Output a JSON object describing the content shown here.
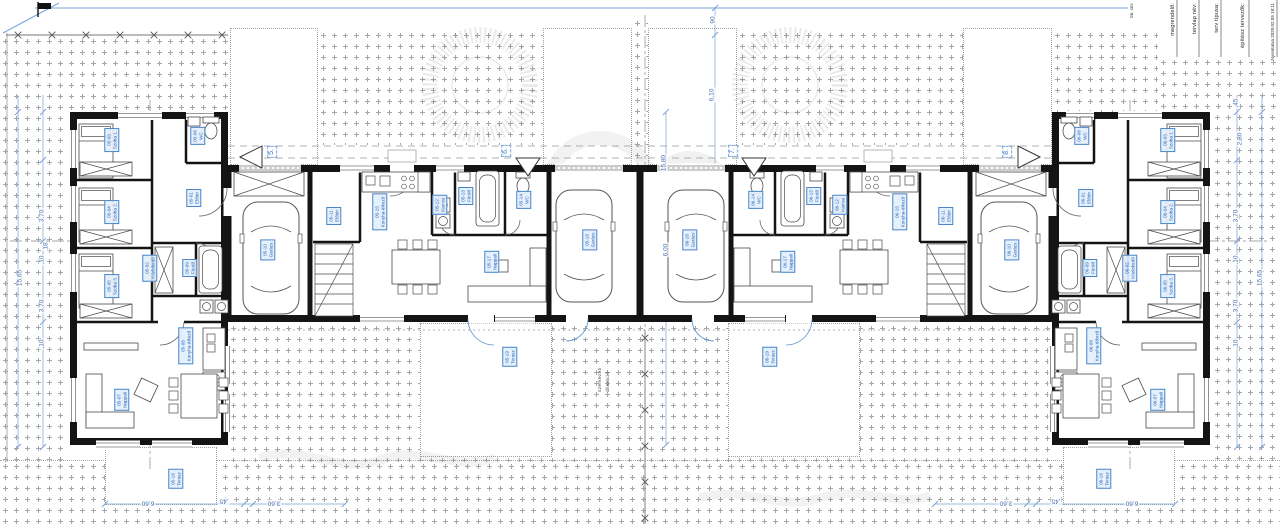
{
  "drawing": {
    "title_block": {
      "fields": [
        "megrendelő:",
        "tervlap név:",
        "terv típusa:",
        "építész tervezők:"
      ],
      "print_note": "Nyomtatva 2020.02.09 18:11",
      "side_note": "tm. cm:"
    },
    "section_markers": [
      {
        "label": "5.",
        "x": 272,
        "y": 152
      },
      {
        "label": "6.",
        "x": 506,
        "y": 151
      },
      {
        "label": "7.",
        "x": 733,
        "y": 151
      },
      {
        "label": "8.",
        "x": 1007,
        "y": 152
      }
    ],
    "room_labels": [
      {
        "code": "05-01",
        "name": "Előtér",
        "x": 194,
        "y": 198
      },
      {
        "code": "05-02",
        "name": "Közlekedő",
        "x": 150,
        "y": 268
      },
      {
        "code": "05-03",
        "name": "Szoba 1.",
        "x": 112,
        "y": 140
      },
      {
        "code": "05-04",
        "name": "Szoba 2.",
        "x": 112,
        "y": 212
      },
      {
        "code": "05-05",
        "name": "Szoba 3.",
        "x": 112,
        "y": 286
      },
      {
        "code": "05-06",
        "name": "WC",
        "x": 198,
        "y": 136
      },
      {
        "code": "05-07",
        "name": "Nappali",
        "x": 122,
        "y": 400
      },
      {
        "code": "05-08",
        "name": "Konyha-étkező",
        "x": 186,
        "y": 346
      },
      {
        "code": "05-09",
        "name": "Fürdő",
        "x": 190,
        "y": 268
      },
      {
        "code": "05-10",
        "name": "Garázs",
        "x": 268,
        "y": 250
      },
      {
        "code": "05-16",
        "name": "Terasz",
        "x": 176,
        "y": 479
      },
      {
        "code": "05-11",
        "name": "Előtér",
        "x": 334,
        "y": 216
      },
      {
        "code": "05-12",
        "name": "Kamra",
        "x": 440,
        "y": 205
      },
      {
        "code": "05-13",
        "name": "Fürdő",
        "x": 466,
        "y": 196
      },
      {
        "code": "05-14",
        "name": "WC",
        "x": 524,
        "y": 200
      },
      {
        "code": "05-15",
        "name": "Konyha-étkező",
        "x": 380,
        "y": 212
      },
      {
        "code": "05-17",
        "name": "Nappali",
        "x": 492,
        "y": 262
      },
      {
        "code": "05-18",
        "name": "Garázs",
        "x": 590,
        "y": 240
      },
      {
        "code": "05-19",
        "name": "Terasz",
        "x": 510,
        "y": 357
      },
      {
        "code": "06-11",
        "name": "Előtér",
        "x": 946,
        "y": 216
      },
      {
        "code": "06-12",
        "name": "Kamra",
        "x": 840,
        "y": 205
      },
      {
        "code": "06-13",
        "name": "Fürdő",
        "x": 814,
        "y": 196
      },
      {
        "code": "06-14",
        "name": "WC",
        "x": 756,
        "y": 200
      },
      {
        "code": "06-15",
        "name": "Konyha-étkező",
        "x": 900,
        "y": 212
      },
      {
        "code": "06-17",
        "name": "Nappali",
        "x": 788,
        "y": 262
      },
      {
        "code": "06-18",
        "name": "Garázs",
        "x": 690,
        "y": 240
      },
      {
        "code": "06-19",
        "name": "Terasz",
        "x": 770,
        "y": 357
      },
      {
        "code": "06-01",
        "name": "Előtér",
        "x": 1086,
        "y": 198
      },
      {
        "code": "06-02",
        "name": "Közlekedő",
        "x": 1130,
        "y": 268
      },
      {
        "code": "06-03",
        "name": "Szoba 1.",
        "x": 1168,
        "y": 140
      },
      {
        "code": "06-04",
        "name": "Szoba 2.",
        "x": 1168,
        "y": 212
      },
      {
        "code": "06-05",
        "name": "Szoba 3.",
        "x": 1168,
        "y": 286
      },
      {
        "code": "06-06",
        "name": "WC",
        "x": 1082,
        "y": 136
      },
      {
        "code": "06-07",
        "name": "Nappali",
        "x": 1158,
        "y": 400
      },
      {
        "code": "06-08",
        "name": "Konyha-étkező",
        "x": 1094,
        "y": 346
      },
      {
        "code": "06-09",
        "name": "Fürdő",
        "x": 1090,
        "y": 268
      },
      {
        "code": "06-10",
        "name": "Garázs",
        "x": 1012,
        "y": 250
      },
      {
        "code": "06-16",
        "name": "Terasz",
        "x": 1104,
        "y": 479
      }
    ],
    "dimensions": [
      {
        "text": "90",
        "x": 713,
        "y": 20
      },
      {
        "text": "6,10",
        "x": 712,
        "y": 95
      },
      {
        "text": "15,80",
        "x": 664,
        "y": 163
      },
      {
        "text": "6,00",
        "x": 666,
        "y": 250
      },
      {
        "text": "18",
        "x": 46,
        "y": 246
      },
      {
        "text": ",45",
        "x": 1236,
        "y": 103
      },
      {
        "text": "2,80",
        "x": 1240,
        "y": 139
      },
      {
        "text": "3,70",
        "x": 1236,
        "y": 216
      },
      {
        "text": ",10",
        "x": 1236,
        "y": 260
      },
      {
        "text": "3,70",
        "x": 1236,
        "y": 306
      },
      {
        "text": ",10",
        "x": 1236,
        "y": 344
      },
      {
        "text": "15,65",
        "x": 1260,
        "y": 278
      },
      {
        "text": "3,70",
        "x": 42,
        "y": 216
      },
      {
        "text": ",10",
        "x": 42,
        "y": 260
      },
      {
        "text": "3,70",
        "x": 42,
        "y": 306
      },
      {
        "text": ",10",
        "x": 42,
        "y": 344
      },
      {
        "text": "15,65",
        "x": 20,
        "y": 278
      },
      {
        "text": "6,60",
        "x": 148,
        "y": 503,
        "rot": 180
      },
      {
        "text": ",45",
        "x": 224,
        "y": 501,
        "rot": 180
      },
      {
        "text": "3,60",
        "x": 274,
        "y": 503,
        "rot": 180
      },
      {
        "text": "3,60",
        "x": 1006,
        "y": 503,
        "rot": 180
      },
      {
        "text": ",45",
        "x": 1056,
        "y": 501,
        "rot": 180
      },
      {
        "text": "6,60",
        "x": 1132,
        "y": 503,
        "rot": 180
      }
    ],
    "notes": [
      {
        "text": "szerkezeti",
        "x": 598,
        "y": 360
      },
      {
        "text": "dilatáció",
        "x": 606,
        "y": 360
      }
    ],
    "colors": {
      "accent_blue": "#4a86c8",
      "dim_blue": "#7aa3d6",
      "wall_black": "#141414",
      "stipple_gray": "#a4a8ac",
      "label_fill": "#e3effd"
    }
  }
}
